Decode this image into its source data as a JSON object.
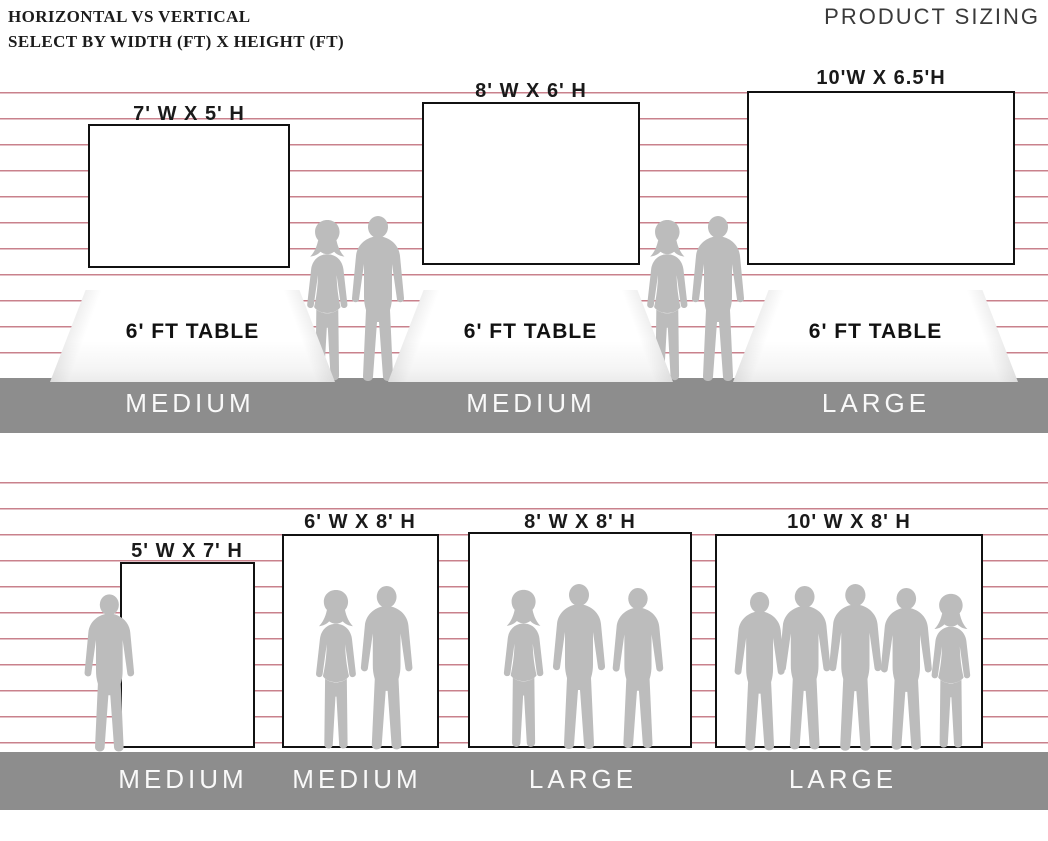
{
  "header": {
    "title_line1": "HORIZONTAL VS VERTICAL",
    "title_line2": "SELECT BY WIDTH (FT) X HEIGHT (FT)",
    "product_sizing": "PRODUCT SIZING"
  },
  "colors": {
    "stripe_red": "#c9818c",
    "floor_gray": "#8d8d8d",
    "silhouette_gray": "#bcbcbc",
    "banner_border": "#111111",
    "size_class_text": "#ffffff"
  },
  "horizontal_section": {
    "banners": [
      {
        "size_label": "7' W X 5' H",
        "table_label": "6' FT TABLE",
        "size_class": "MEDIUM"
      },
      {
        "size_label": "8' W X 6' H",
        "table_label": "6' FT TABLE",
        "size_class": "MEDIUM"
      },
      {
        "size_label": "10'W X 6.5'H",
        "table_label": "6' FT TABLE",
        "size_class": "LARGE"
      }
    ]
  },
  "vertical_section": {
    "banners": [
      {
        "size_label": "5' W X 7' H",
        "size_class": "MEDIUM"
      },
      {
        "size_label": "6' W X 8' H",
        "size_class": "MEDIUM"
      },
      {
        "size_label": "8' W X 8' H",
        "size_class": "LARGE"
      },
      {
        "size_label": "10' W X 8' H",
        "size_class": "LARGE"
      }
    ]
  }
}
